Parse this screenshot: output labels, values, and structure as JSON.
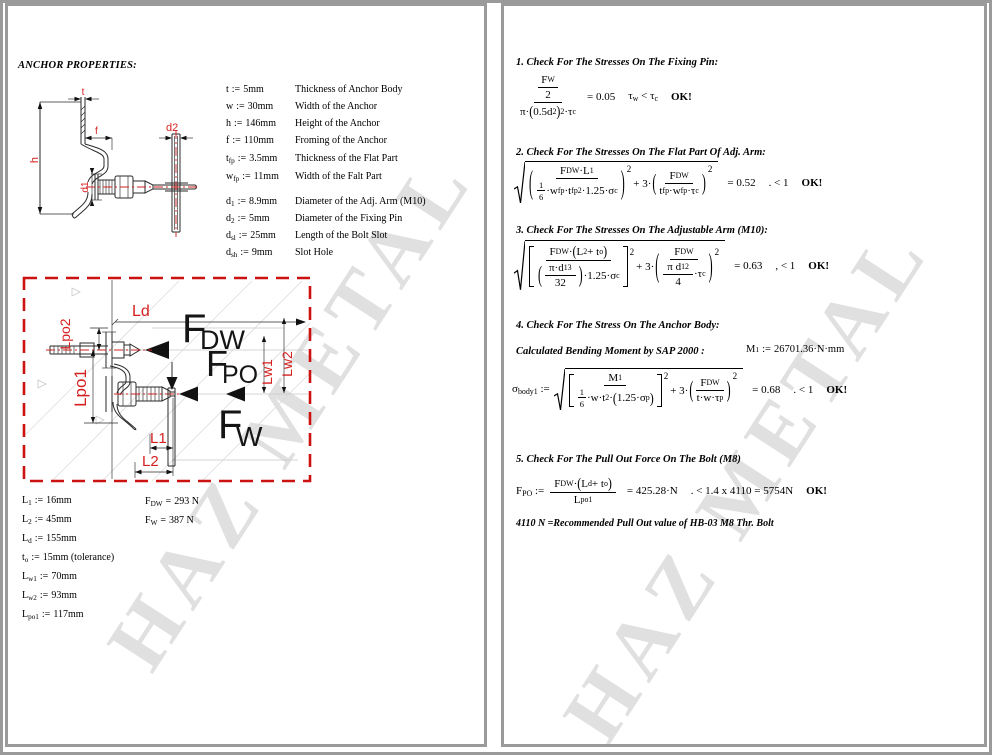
{
  "watermark": {
    "text": "HAZ METAL"
  },
  "colors": {
    "dim_red": "#d62020",
    "border_gray": "#9a9a9a",
    "centerline_red": "#cc2020"
  },
  "p1": {
    "heading": "ANCHOR PROPERTIES:",
    "assign_op": ":=",
    "eval_op": "=",
    "props": [
      {
        "sym": "t",
        "sub": "",
        "val": "5mm",
        "desc": "Thickness of Anchor Body"
      },
      {
        "sym": "w",
        "sub": "",
        "val": "30mm",
        "desc": "Width of the Anchor"
      },
      {
        "sym": "h",
        "sub": "",
        "val": "146mm",
        "desc": "Height of the Anchor"
      },
      {
        "sym": "f",
        "sub": "",
        "val": "110mm",
        "desc": "Froming of the Anchor"
      },
      {
        "sym": "t",
        "sub": "fp",
        "val": "3.5mm",
        "desc": "Thickness of the Flat Part"
      },
      {
        "sym": "w",
        "sub": "fp",
        "val": "11mm",
        "desc": "Width of the Falt Part"
      },
      {
        "sym": "d",
        "sub": "1",
        "val": "8.9mm",
        "desc": "Diameter of the Adj. Arm (M10)"
      },
      {
        "sym": "d",
        "sub": "2",
        "val": "5mm",
        "desc": "Diameter of the Fixing Pin"
      },
      {
        "sym": "d",
        "sub": "sl",
        "val": "25mm",
        "desc": "Length of the Bolt Slot"
      },
      {
        "sym": "d",
        "sub": "sh",
        "val": "9mm",
        "desc": "Slot Hole"
      }
    ],
    "lengths": [
      {
        "sym": "L",
        "sub": "1",
        "val": "16mm"
      },
      {
        "sym": "L",
        "sub": "2",
        "val": "45mm"
      },
      {
        "sym": "L",
        "sub": "d",
        "val": "155mm"
      },
      {
        "sym": "t",
        "sub": "o",
        "val": "15mm (tolerance)"
      },
      {
        "sym": "L",
        "sub": "w1",
        "val": "70mm"
      },
      {
        "sym": "L",
        "sub": "w2",
        "val": "93mm"
      },
      {
        "sym": "L",
        "sub": "po1",
        "val": "117mm"
      }
    ],
    "forces": [
      {
        "sym": "F",
        "sub": "DW",
        "val": "293 N"
      },
      {
        "sym": "F",
        "sub": "W",
        "val": "387 N"
      }
    ],
    "d1_labels": {
      "t": "t",
      "h": "h",
      "f": "f",
      "d1": "d1",
      "d2": "d2"
    },
    "d2_labels": {
      "ld": "Ld",
      "lpo2": "Lpo2",
      "lpo1": "Lpo1",
      "l1": "L1",
      "l2": "L2",
      "lw1": "Lw1",
      "lw2": "Lw2",
      "fdw": "F",
      "fdw_sub": "DW",
      "fpo": "F",
      "fpo_sub": "PO",
      "fw": "F",
      "fw_sub": "W"
    }
  },
  "p2": {
    "s1": {
      "h": "1. Check For The Stresses On The Fixing Pin:",
      "numF": "F",
      "numFs": "W",
      "num2": "2",
      "d1": "π·",
      "lp": "(",
      "d2": "0.5d",
      "d2s": "2",
      "rp": ")",
      "sq": "2",
      "d3": "·τ",
      "d3s": "c",
      "res": "= 0.05",
      "cA": "τ",
      "cAs": "w",
      "clt": "<",
      "cB": "τ",
      "cBs": "c",
      "ok": "OK!"
    },
    "s2": {
      "h": "2. Check For The Stresses On The Flat Part Of Adj. Arm:",
      "n1a": "F",
      "n1as": "DW",
      "n1b": "·L",
      "n1bs": "1",
      "one": "1",
      "six": "6",
      "dwa": "·w",
      "dwas": "fp",
      "dta": "·t",
      "dtas": "fp",
      "dsq": "2",
      "dsb": "·1.25·σ",
      "dsbs": "c",
      "plus": "+ 3·",
      "sq": "2",
      "n2": "F",
      "n2s": "DW",
      "d2a": "t",
      "d2as": "fp",
      "d2b": "·w",
      "d2bs": "fp",
      "d2c": "·τ",
      "d2cs": "c",
      "res": "= 0.52",
      "cond": ". < 1",
      "ok": "OK!"
    },
    "s3": {
      "h": "3. Check For The Stresses On The Adjustable Arm (M10):",
      "n1a": "F",
      "n1as": "DW",
      "n1b": "·",
      "lp": "(",
      "n1c": "L",
      "n1cs": "2",
      "n1d": " + t",
      "n1ds": "o",
      "rp": ")",
      "dfa": "π·d",
      "dfas": "1",
      "dfsq": "3",
      "dfb": "32",
      "dtail": "·1.25·σ",
      "dtails": "c",
      "plus": "+ 3·",
      "sq": "2",
      "n2": "F",
      "n2s": "DW",
      "d2a": "π d",
      "d2as": "1",
      "d2sq": "2",
      "d2b": "4",
      "d2c": "·τ",
      "d2cs": "c",
      "res": "= 0.63",
      "cond": ", < 1",
      "ok": "OK!"
    },
    "s4": {
      "h": "4. Check For The Stress On The Anchor Body:",
      "calc": "Calculated Bending Moment by SAP 2000 :",
      "m": "M",
      "ms": "1",
      "mop": ":=",
      "mval": "26701.36·N·mm",
      "lhs": "σ",
      "lhss": "body1",
      "op": ":=",
      "n1": "M",
      "n1s": "1",
      "one": "1",
      "six": "6",
      "da": "·w·t",
      "dsq": "2",
      "db": "·",
      "lp": "(",
      "dc": "1.25·σ",
      "dcs": "p",
      "rp": ")",
      "plus": "+ 3·",
      "sq": "2",
      "n2": "F",
      "n2s": "DW",
      "d2a": "t·w·τ",
      "d2as": "p",
      "res": "= 0.68",
      "cond": ". < 1",
      "ok": "OK!"
    },
    "s5": {
      "h": "5. Check For The Pull Out Force On The Bolt (M8)",
      "lhs": "F",
      "lhss": "PO",
      "op": ":=",
      "na": "F",
      "nas": "DW",
      "nb": "·",
      "lp": "(",
      "nc": "L",
      "ncs": "d",
      "nd": " + t",
      "nds": "o",
      "rp": ")",
      "da": "L",
      "das": "po1",
      "res": "= 425.28·N",
      "cond": ". < 1.4 x 4110 = 5754N",
      "ok": "OK!",
      "note": "4110 N =Recommended Pull Out value of HB-03 M8 Thr. Bolt"
    }
  }
}
